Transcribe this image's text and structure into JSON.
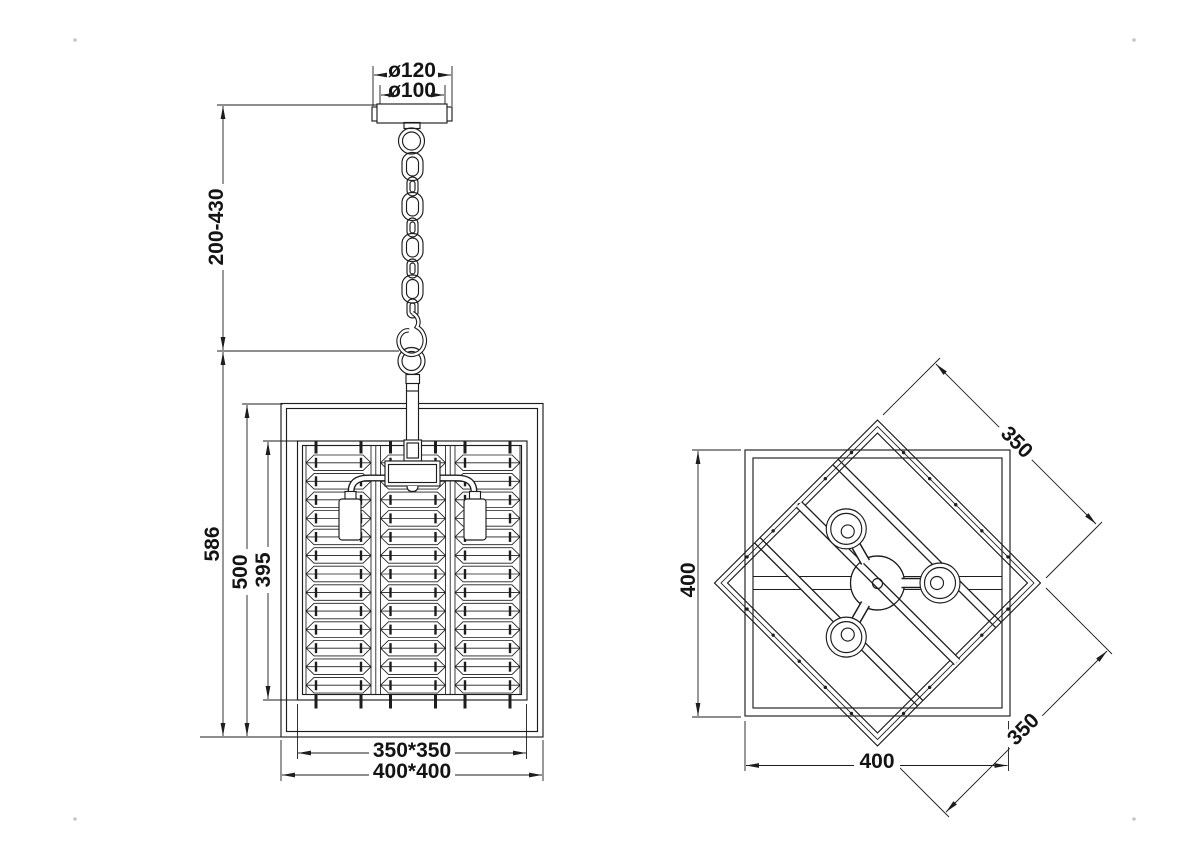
{
  "drawing": {
    "front_view": {
      "canopy_outer_dia": "ø120",
      "canopy_inner_dia": "ø100",
      "suspension_height": "200-430",
      "overall_height": "586",
      "frame_height": "500",
      "shade_height": "395",
      "shade_width": "350*350",
      "frame_width": "400*400"
    },
    "top_view": {
      "frame_depth": "400",
      "frame_width": "400",
      "shade_side_upper": "350",
      "shade_side_lower": "350"
    },
    "colors": {
      "line": "#1d1d1d",
      "background": "#ffffff"
    }
  }
}
